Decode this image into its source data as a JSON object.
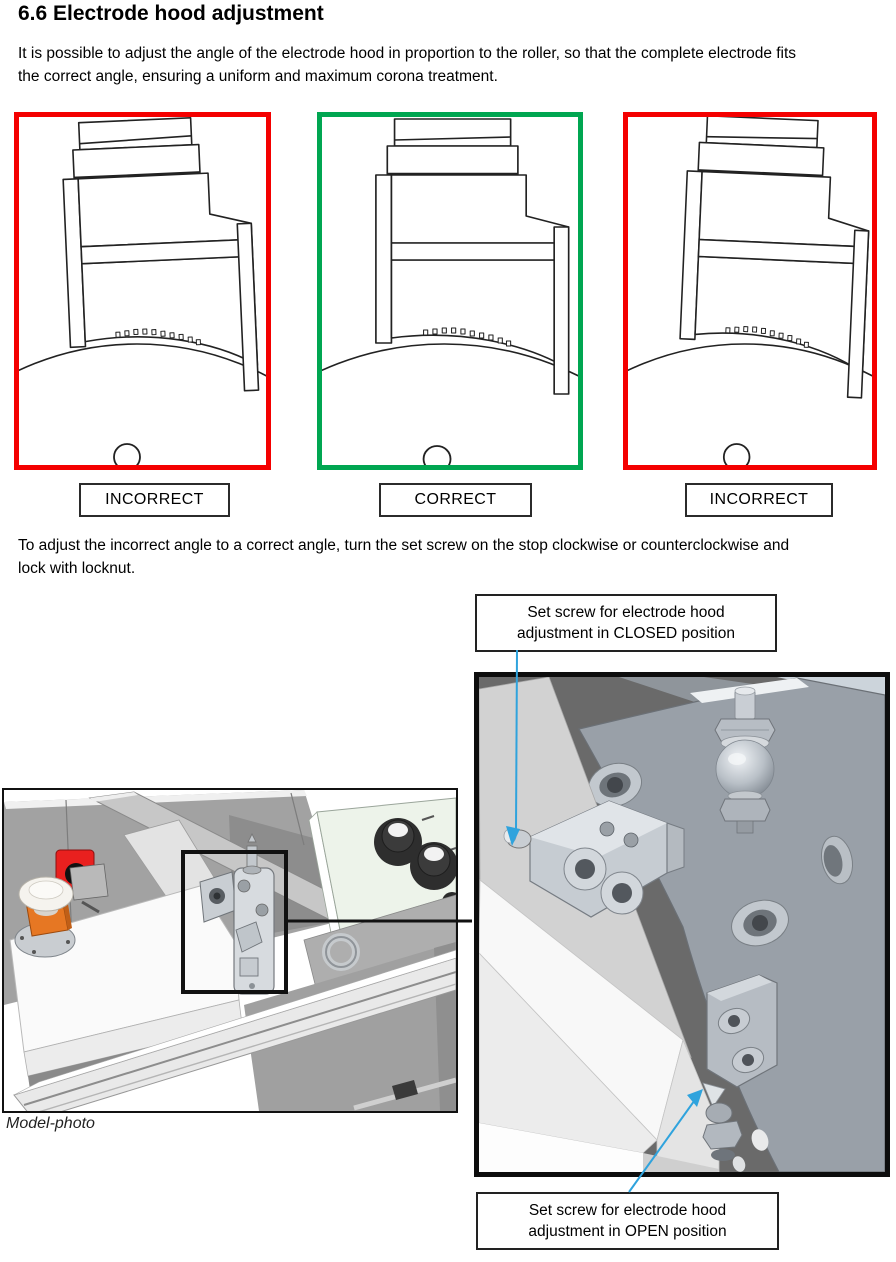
{
  "page": {
    "heading": "6.6 Electrode hood adjustment",
    "intro": "It is possible to adjust the angle of the electrode hood in proportion to the roller, so that the complete electrode fits the correct angle, ensuring a uniform and maximum corona treatment.",
    "adjust_note": "To adjust the incorrect angle to a correct angle, turn the set screw on the stop clockwise or counterclockwise and lock with locknut."
  },
  "diagrams": [
    {
      "label": "INCORRECT",
      "frame_color": "#f40000"
    },
    {
      "label": "CORRECT",
      "frame_color": "#00a651"
    },
    {
      "label": "INCORRECT",
      "frame_color": "#f40000"
    }
  ],
  "callouts": {
    "closed": [
      "Set screw for electrode hood",
      "adjustment in CLOSED position"
    ],
    "open": [
      "Set screw for electrode hood",
      "adjustment in OPEN position"
    ]
  },
  "caption": "Model-photo",
  "colors": {
    "frame_red": "#f40000",
    "frame_green": "#00a651",
    "leader_blue": "#2fa3dd",
    "highlight_black": "#111111"
  }
}
